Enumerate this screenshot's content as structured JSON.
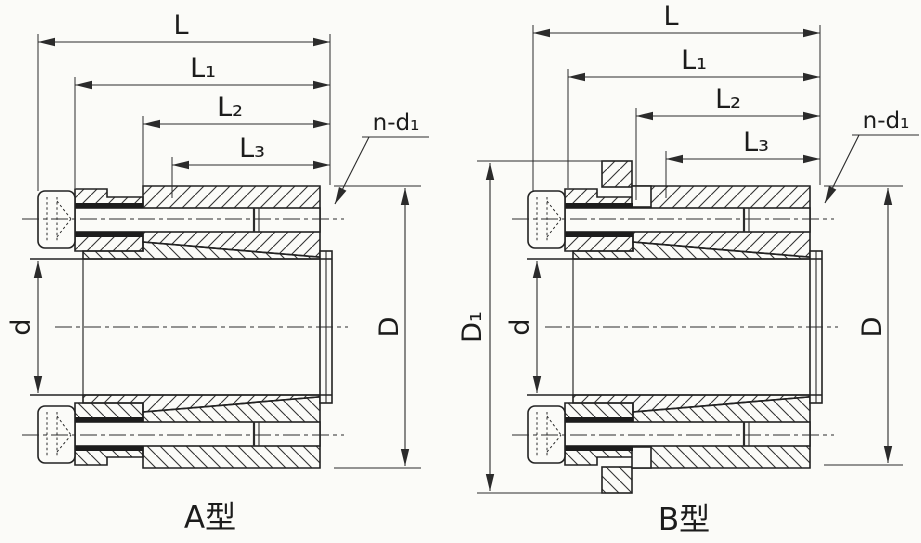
{
  "figure": {
    "description": "Cross-section engineering drawing of a keyless shaft locking assembly, two variants",
    "colors": {
      "line": "#2b2b2b",
      "background": "#fbfbf8"
    }
  },
  "drawing_a": {
    "caption": "A型",
    "dims": {
      "L": "L",
      "L1": "L₁",
      "L2": "L₂",
      "L3": "L₃",
      "n_d1": "n-d₁",
      "d": "d",
      "D": "D"
    }
  },
  "drawing_b": {
    "caption": "B型",
    "dims": {
      "L": "L",
      "L1": "L₁",
      "L2": "L₂",
      "L3": "L₃",
      "n_d1": "n-d₁",
      "d": "d",
      "D": "D",
      "D1": "D₁"
    }
  }
}
